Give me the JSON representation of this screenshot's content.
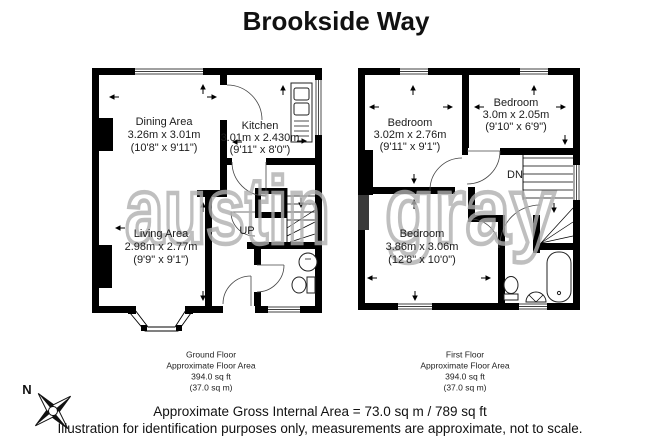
{
  "title": "Brookside Way",
  "watermark": {
    "word1": "austin",
    "word2": "gray"
  },
  "ground_floor": {
    "rooms": {
      "dining": {
        "name": "Dining Area",
        "metric": "3.26m x 3.01m",
        "imperial": "(10'8\" x 9'11\")"
      },
      "kitchen": {
        "name": "Kitchen",
        "metric": "3.01m x 2.430m",
        "imperial": "(9'11\" x 8'0\")"
      },
      "living": {
        "name": "Living Area",
        "metric": "2.98m x 2.77m",
        "imperial": "(9'9\" x 9'1\")"
      }
    },
    "stairs": "UP",
    "caption": {
      "floor": "Ground Floor",
      "area_label": "Approximate Floor Area",
      "area_ft": "394.0 sq ft",
      "area_m": "(37.0 sq m)"
    }
  },
  "first_floor": {
    "rooms": {
      "bedroom1": {
        "name": "Bedroom",
        "metric": "3.02m x 2.76m",
        "imperial": "(9'11\" x 9'1\")"
      },
      "bedroom2": {
        "name": "Bedroom",
        "metric": "3.0m x 2.05m",
        "imperial": "(9'10\" x 6'9\")"
      },
      "bedroom3": {
        "name": "Bedroom",
        "metric": "3.86m x 3.06m",
        "imperial": "(12'8\" x 10'0\")"
      }
    },
    "stairs": "DN",
    "caption": {
      "floor": "First Floor",
      "area_label": "Approximate Floor Area",
      "area_ft": "394.0 sq ft",
      "area_m": "(37.0 sq m)"
    }
  },
  "compass": {
    "north": "N"
  },
  "footer": {
    "gross_area": "Approximate Gross Internal Area = 73.0 sq m / 789 sq ft",
    "disclaimer": "Illustration for identification purposes only, measurements are approximate, not to scale."
  }
}
